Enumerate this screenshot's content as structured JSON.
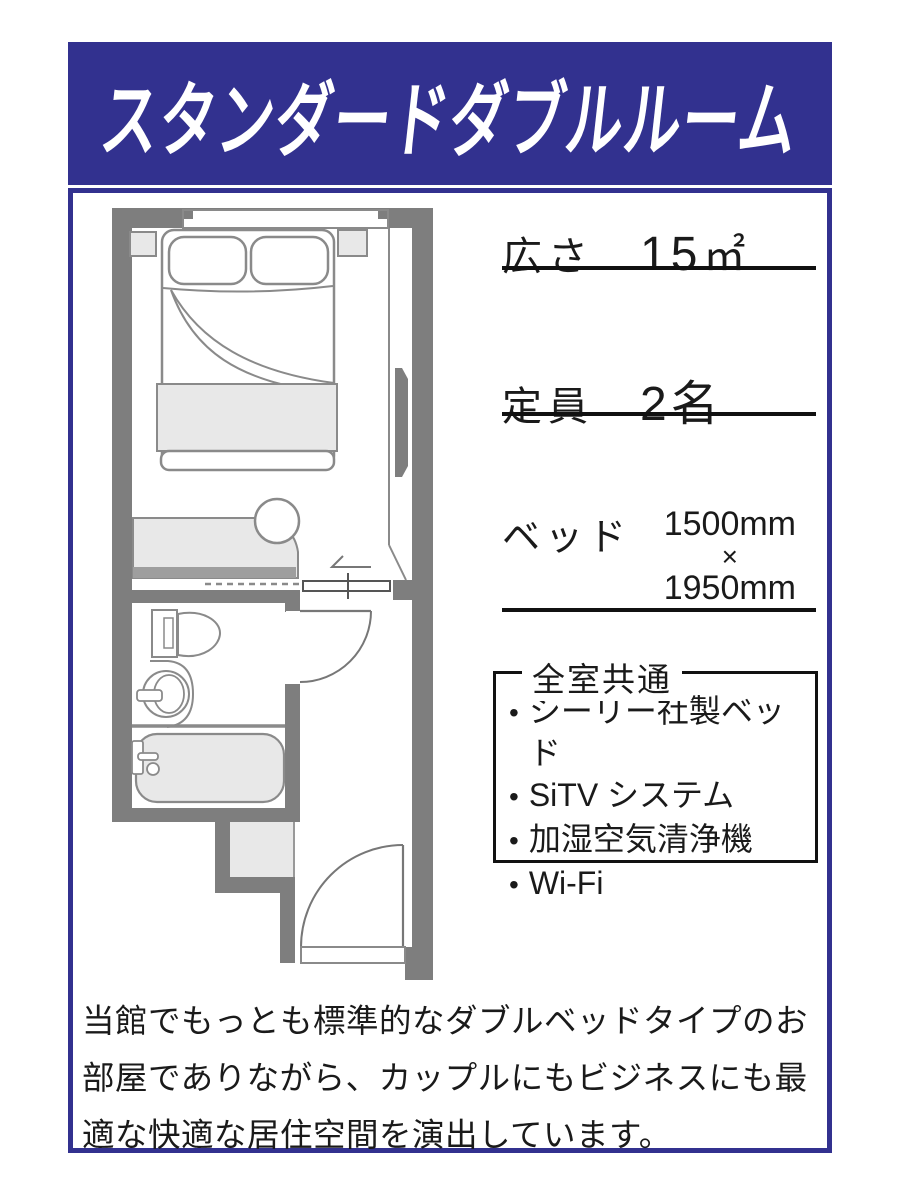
{
  "colors": {
    "navy": "#32318f",
    "wall_gray": "#7e7e7e",
    "furniture_light_gray": "#e8e8e8",
    "outline_gray": "#8a8a8a",
    "text_black": "#1a1a1a"
  },
  "header": {
    "title": "スタンダードダブルルーム"
  },
  "specs": {
    "area": {
      "label": "広さ",
      "value": "15",
      "unit": "㎡"
    },
    "capacity": {
      "label": "定員",
      "value": "2名"
    },
    "bed": {
      "label": "ベッド",
      "width": "1500mm",
      "times": "×",
      "length": "1950mm"
    }
  },
  "amenities": {
    "title": "全室共通",
    "bullet": "•",
    "items": [
      "シーリー社製ベッド",
      "SiTV システム",
      "加湿空気清浄機",
      "Wi-Fi"
    ]
  },
  "description": "当館でもっとも標準的なダブルベッドタイプのお部屋でありながら、カップルにもビジネスにも最適な快適な居住空間を演出しています。",
  "floor_plan": {
    "depicts": [
      "double-bed",
      "pillows",
      "nightstands",
      "window",
      "wall-mirror-panel",
      "desk-counter",
      "stool",
      "sliding-partition",
      "bathroom",
      "toilet",
      "washbasin",
      "bathtub",
      "bathroom-door",
      "closet",
      "entrance-door"
    ]
  }
}
